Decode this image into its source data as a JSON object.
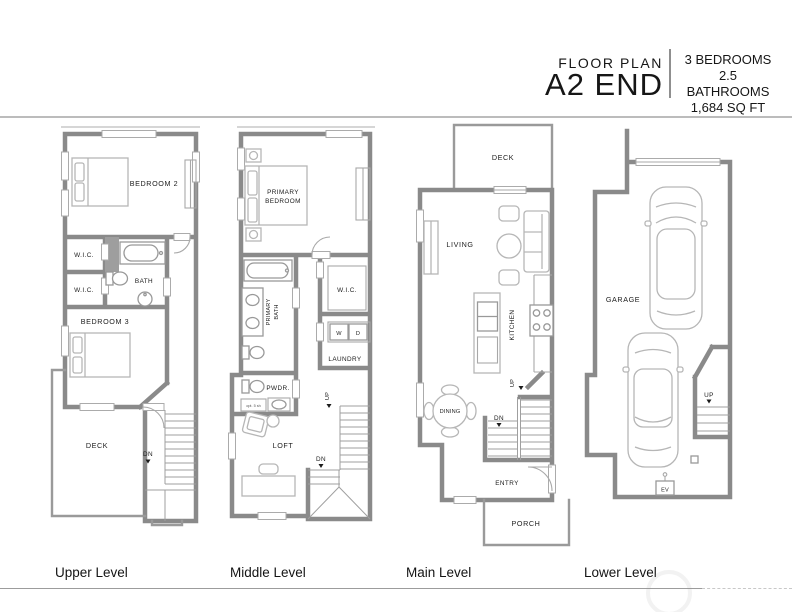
{
  "header": {
    "floor_plan_label": "FLOOR PLAN",
    "plan_name": "A2 END",
    "specs": [
      "3 BEDROOMS",
      "2.5 BATHROOMS",
      "1,684 SQ FT"
    ]
  },
  "upper": {
    "caption": "Upper Level",
    "bedroom2": "BEDROOM 2",
    "wic_a": "W.I.C.",
    "wic_b": "W.I.C.",
    "bath": "BATH",
    "bedroom3": "BEDROOM 3",
    "deck": "DECK",
    "dn": "DN"
  },
  "middle": {
    "caption": "Middle Level",
    "primary_line1": "PRIMARY",
    "primary_line2": "BEDROOM",
    "primary_bath_line1": "PRIMARY",
    "primary_bath_line2": "BATH",
    "wic": "W.I.C.",
    "washer": "W",
    "dryer": "D",
    "laundry": "LAUNDRY",
    "powder": "PWDR.",
    "shelf_note": "opt. 5 sh",
    "loft": "LOFT",
    "up": "UP",
    "dn": "DN"
  },
  "main": {
    "caption": "Main Level",
    "deck": "DECK",
    "living": "LIVING",
    "kitchen": "KITCHEN",
    "dining": "DINING",
    "up": "UP",
    "dn": "DN",
    "entry": "ENTRY",
    "porch": "PORCH"
  },
  "lower": {
    "caption": "Lower Level",
    "garage": "GARAGE",
    "up": "UP",
    "ev": "EV"
  },
  "colors": {
    "wall": "#8a8a8a",
    "furniture": "#b6b6b6",
    "text": "#1c1c1c",
    "rule": "#9c9c9c"
  }
}
